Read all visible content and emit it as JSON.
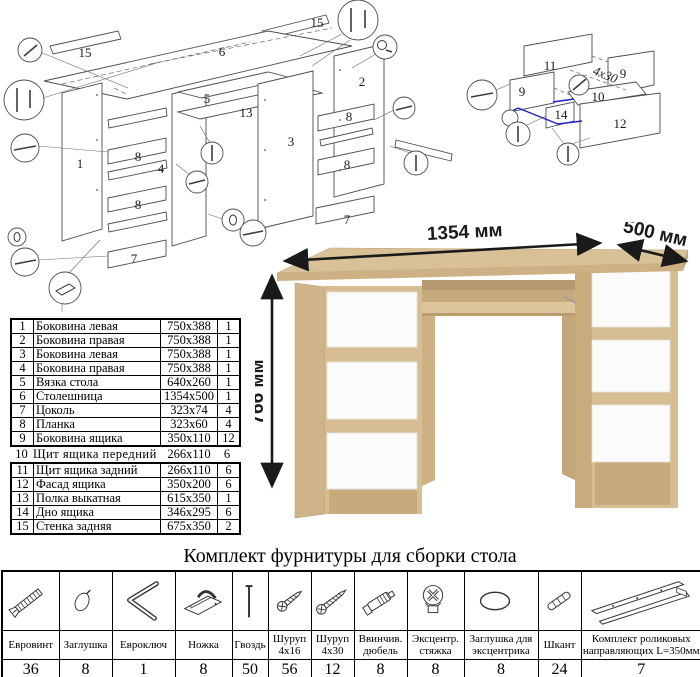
{
  "diagram": {
    "main_labels": [
      "15",
      "6",
      "15",
      "5",
      "13",
      "2",
      "3",
      "1",
      "8",
      "4",
      "8",
      "7",
      "8",
      "8",
      "7"
    ],
    "drawer_labels": [
      "11",
      "9",
      "9",
      "10",
      "14",
      "12"
    ],
    "screw_note": "4x30"
  },
  "desk": {
    "dimensions": {
      "width": "1354 мм",
      "depth": "500 мм",
      "height": "766 мм"
    },
    "colors": {
      "wood_top": "#d8c196",
      "wood_front": "#cdb184",
      "wood_side": "#cfb489",
      "wood_dark": "#b69872",
      "drawer_white": "#fbfbfb"
    }
  },
  "parts": {
    "rows": [
      {
        "n": "1",
        "name": "Боковина левая",
        "size": "750x388",
        "q": "1"
      },
      {
        "n": "2",
        "name": "Боковина правая",
        "size": "750x388",
        "q": "1"
      },
      {
        "n": "3",
        "name": "Боковина левая",
        "size": "750x388",
        "q": "1"
      },
      {
        "n": "4",
        "name": "Боковина правая",
        "size": "750x388",
        "q": "1"
      },
      {
        "n": "5",
        "name": "Вязка стола",
        "size": "640x260",
        "q": "1"
      },
      {
        "n": "6",
        "name": "Столешница",
        "size": "1354x500",
        "q": "1"
      },
      {
        "n": "7",
        "name": "Цоколь",
        "size": "323x74",
        "q": "4"
      },
      {
        "n": "8",
        "name": "Планка",
        "size": "323x60",
        "q": "4"
      },
      {
        "n": "9",
        "name": "Боковина ящика",
        "size": "350x110",
        "q": "12"
      },
      {
        "n": "10",
        "name": "Щит ящика передний",
        "size": "266x110",
        "q": "6"
      },
      {
        "n": "11",
        "name": "Щит ящика задний",
        "size": "266x110",
        "q": "6"
      },
      {
        "n": "12",
        "name": "Фасад ящика",
        "size": "350x200",
        "q": "6"
      },
      {
        "n": "13",
        "name": "Полка выкатная",
        "size": "615x350",
        "q": "1"
      },
      {
        "n": "14",
        "name": "Дно ящика",
        "size": "346x295",
        "q": "6"
      },
      {
        "n": "15",
        "name": "Стенка задняя",
        "size": "675x350",
        "q": "2"
      }
    ]
  },
  "hardware": {
    "title": "Комплект фурнитуры для сборки стола",
    "items": [
      {
        "name": "Евровинт",
        "qty": "36",
        "icon": "confirmat-screw-icon"
      },
      {
        "name": "Заглушка",
        "qty": "8",
        "icon": "cap-icon"
      },
      {
        "name": "Евроключ",
        "qty": "1",
        "icon": "hex-key-icon"
      },
      {
        "name": "Ножка",
        "qty": "8",
        "icon": "foot-icon"
      },
      {
        "name": "Гвоздь",
        "qty": "50",
        "icon": "nail-icon"
      },
      {
        "name": "Шуруп 4x16",
        "qty": "56",
        "icon": "screw-icon"
      },
      {
        "name": "Шуруп 4x30",
        "qty": "12",
        "icon": "screw-icon"
      },
      {
        "name": "Ввинчив. дюбель",
        "qty": "8",
        "icon": "threaded-dowel-icon"
      },
      {
        "name": "Эксцентр. стяжка",
        "qty": "8",
        "icon": "eccentric-cam-icon"
      },
      {
        "name": "Заглушка для эксцентрика",
        "qty": "8",
        "icon": "cam-cap-icon"
      },
      {
        "name": "Шкант",
        "qty": "24",
        "icon": "wood-dowel-icon"
      },
      {
        "name": "Комплект роликовых направляющих L=350мм",
        "qty": "7",
        "icon": "roller-slides-icon"
      }
    ]
  }
}
